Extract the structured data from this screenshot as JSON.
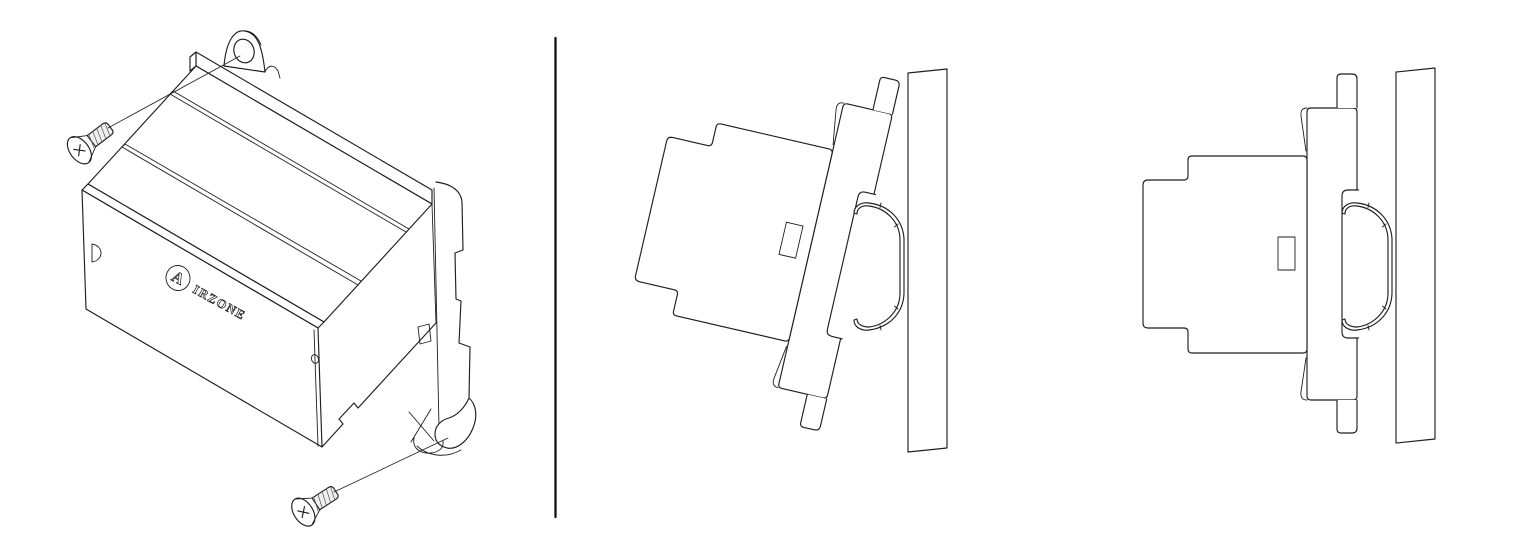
{
  "canvas": {
    "background": "#ffffff",
    "line_color": "#1f1f1f",
    "divider_color": "#111111"
  },
  "logo": {
    "circle_letter": "A",
    "wordmark": "IRZONE"
  }
}
